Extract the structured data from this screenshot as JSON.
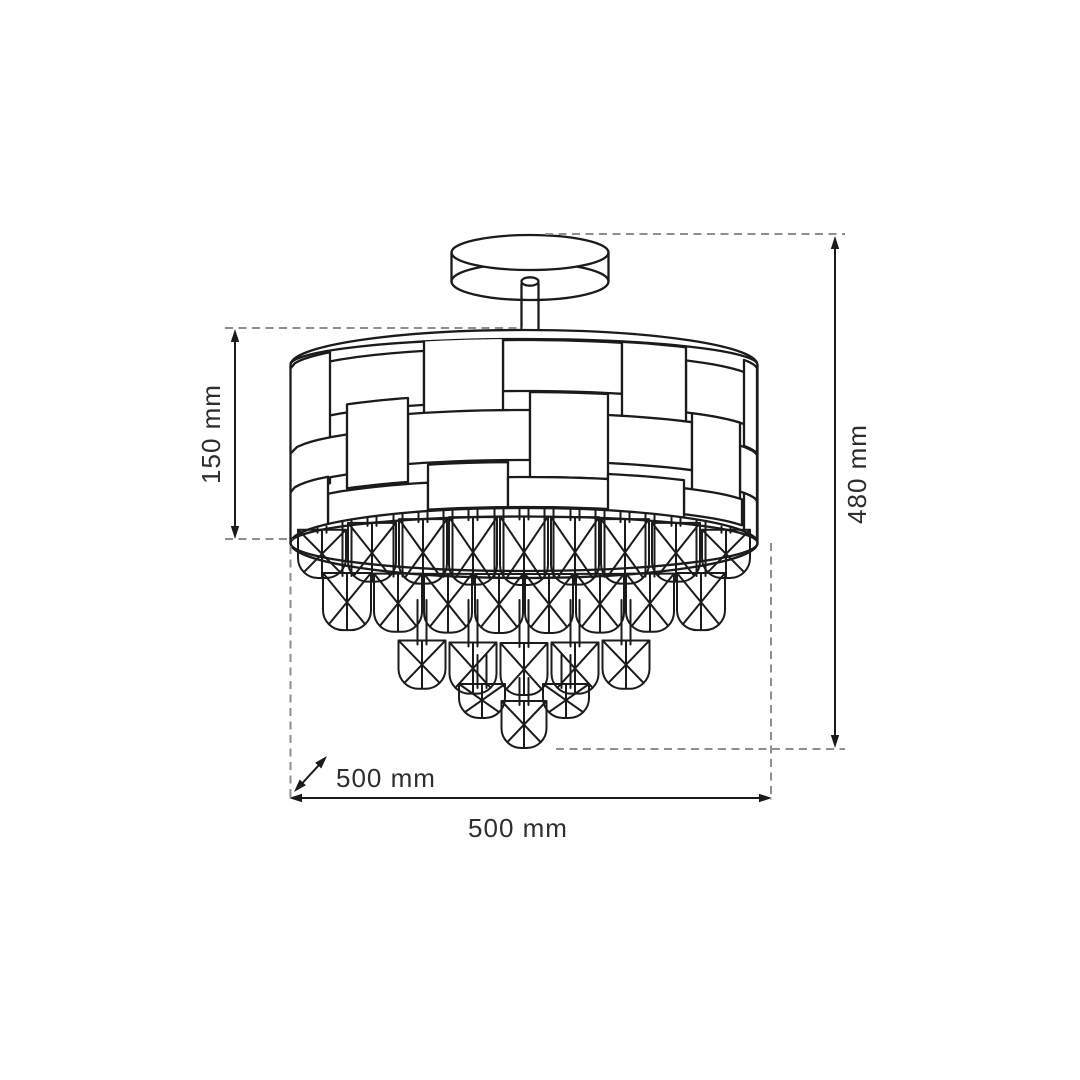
{
  "labels": {
    "shade_height": "150 mm",
    "total_height": "480 mm",
    "depth": "500 mm",
    "width": "500 mm"
  },
  "colors": {
    "background": "#ffffff",
    "line": "#1b1b1b",
    "extension_dash": "#8f8f8f",
    "text": "#2e2e2e"
  },
  "figure": {
    "drum": {
      "cx": 524,
      "rx": 233.5,
      "wall_top": 365,
      "wall_bottom": 543,
      "left": 290.5,
      "right": 757.5
    },
    "weave_rows": [
      {
        "h": [
          [
            290,
            424,
            348,
            402
          ],
          [
            503,
            622,
            340,
            391
          ],
          [
            686,
            757,
            352,
            404
          ]
        ],
        "v": [
          [
            290,
            330,
            339,
            470
          ],
          [
            424,
            503,
            337,
            412
          ],
          [
            622,
            686,
            339,
            421
          ],
          [
            744,
            757,
            340,
            426
          ]
        ]
      },
      {
        "h": [
          [
            290,
            347,
            424,
            464
          ],
          [
            408,
            530,
            410,
            460
          ],
          [
            596,
            692,
            413,
            461
          ],
          [
            740,
            757,
            427,
            473
          ]
        ],
        "v": [
          [
            347,
            408,
            394,
            478
          ],
          [
            530,
            608,
            392,
            477
          ],
          [
            692,
            740,
            404,
            490
          ]
        ]
      },
      {
        "h": [
          [
            328,
            428,
            480,
            516
          ],
          [
            428,
            508,
            462,
            507
          ],
          [
            508,
            628,
            477,
            507
          ],
          [
            684,
            742,
            480,
            506
          ]
        ],
        "v": [
          [
            290,
            328,
            463,
            512
          ],
          [
            608,
            684,
            472,
            514
          ],
          [
            744,
            757,
            473,
            512
          ]
        ]
      }
    ],
    "crystal_rows": [
      {
        "offsets": [
          -202,
          -152,
          -101,
          -51,
          0,
          51,
          101,
          152,
          202
        ],
        "w": 48,
        "band": true
      },
      {
        "offsets": [
          -177,
          -126,
          -76,
          -25,
          25,
          76,
          126,
          177
        ],
        "w": 48,
        "top": [
          572,
          574
        ],
        "bottom": [
          627,
          633
        ],
        "band_stem": true
      },
      {
        "offsets": [
          -102,
          -51,
          0,
          51,
          102
        ],
        "w": 47,
        "top": [
          636,
          643
        ],
        "bottom": [
          678,
          695
        ],
        "stem": [
          600,
          648
        ]
      },
      {
        "offsets": [
          -42,
          42
        ],
        "w": 46,
        "top": [
          684,
          684
        ],
        "bottom": [
          718,
          718
        ],
        "stem": [
          655,
          688
        ]
      },
      {
        "offsets": [
          0
        ],
        "w": 45,
        "top": [
          701,
          701
        ],
        "bottom": [
          748,
          748
        ],
        "stem": [
          678,
          705
        ]
      }
    ]
  }
}
